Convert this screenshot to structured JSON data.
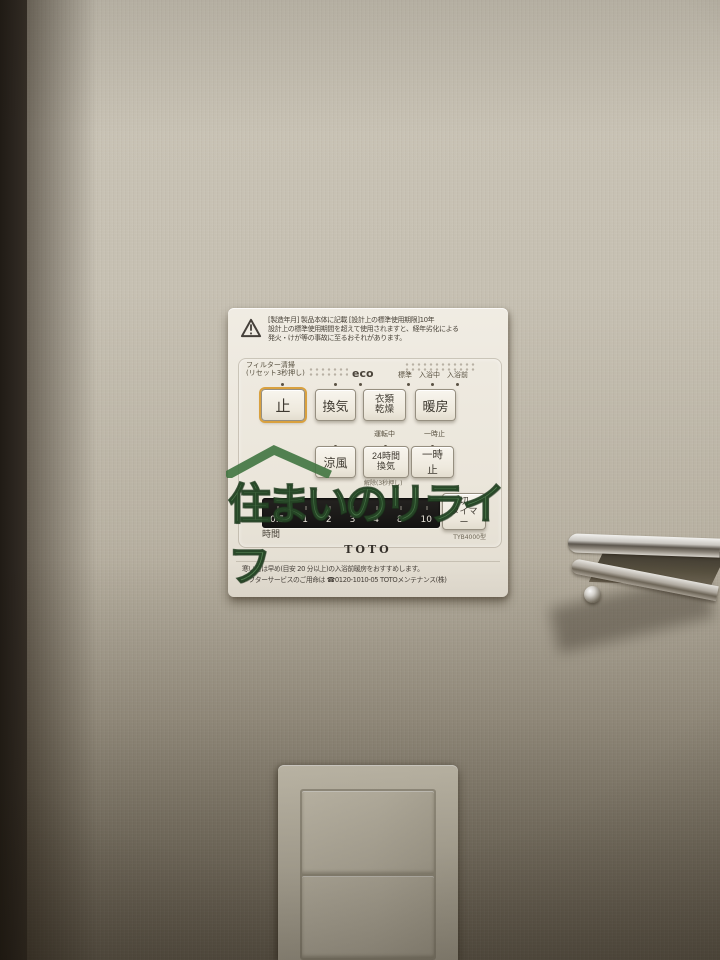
{
  "watermark": {
    "text": "住まいのリライフ",
    "color": "#4a7c4a"
  },
  "panel": {
    "warning_text": "[製造年月] 製品本体に記載  [設計上の標準使用期限]10年\n設計上の標準使用期間を超えて使用されますと、経年劣化による\n発火・けが等の事故に至るおそれがあります。",
    "labels": {
      "filter": "フィルター清掃\n(リセット3秒押し)",
      "eco": "eco",
      "mode_standard": "標準",
      "mode_bathing": "入浴中",
      "mode_prebath": "入浴前",
      "running": "運転中",
      "pause_small": "一時止",
      "release": "解除(3秒押し)",
      "hours": "時間",
      "model": "TYB4000型"
    },
    "buttons": {
      "stop": "止",
      "ventilation": "換気",
      "clothes_drying": "衣類\n乾燥",
      "heating": "暖房",
      "cool_breeze": "涼風",
      "vent_24h": "24時間\n換気",
      "pause": "一時止",
      "off_timer": "切\nタイマー"
    },
    "timer_scale": [
      "0.5",
      "1",
      "2",
      "3",
      "4",
      "8",
      "10"
    ],
    "brand": "TOTO",
    "footer_text": "寒い日は早め(目安 20 分以上)の入浴前暖房をおすすめします。\nアフターサービスのご用命は ☎0120-1010-05  TOTOメンテナンス(株)",
    "accent_color": "#d9a13f"
  }
}
